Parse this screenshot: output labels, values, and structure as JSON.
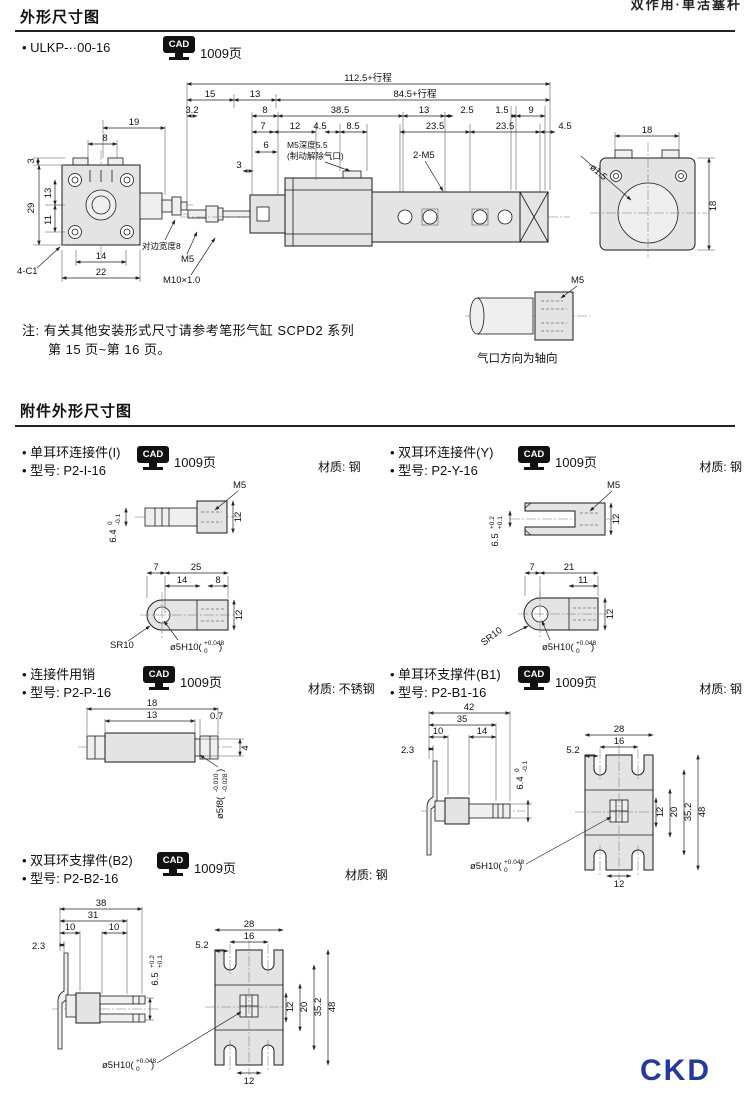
{
  "page": {
    "header_right": "双作用·单活塞杆",
    "logo": "CKD",
    "logo_color": "#2438a0"
  },
  "shared": {
    "cad_label": "CAD",
    "cad_page": "1009页",
    "hole_prefix": "ø5H10(",
    "hole_sup": "+0.048",
    "hole_sub": "0",
    "hole_close": ")"
  },
  "section1": {
    "title": "外形尺寸图",
    "model": "• ULKP-··00-16",
    "note1": "注: 有关其他安装形式尺寸请参考笔形气缸 SCPD2 系列",
    "note2": "第 15 页~第 16 页。",
    "port_caption": "气口方向为轴向",
    "main": {
      "total": "112.5+行程",
      "sub_total": "84.5+行程",
      "d15": "15",
      "d13a": "13",
      "d32": "3.2",
      "d8a": "8",
      "d385": "38.5",
      "d13b": "13",
      "d25a": "2.5",
      "d15b": "1.5",
      "d9": "9",
      "d7": "7",
      "d12": "12",
      "d45a": "4.5",
      "d85": "8.5",
      "d235a": "23.5",
      "d235b": "23.5",
      "d45b": "4.5",
      "d6": "6",
      "d3a": "3",
      "m5_depth": "M5深度5.5",
      "brake_port": "(制动解除气口)",
      "m5x2": "2-M5",
      "lv_19": "19",
      "lv_8": "8",
      "lv_3": "3",
      "lv_29": "29",
      "lv_13": "13",
      "lv_11": "11",
      "lv_14": "14",
      "lv_22": "22",
      "lv_c1": "4-C1",
      "lv_flats": "对边宽度8",
      "lv_m5": "M5",
      "lv_m10": "M10×1.0",
      "rv_18t": "18",
      "rv_18r": "18",
      "rv_hole": "·ø1.5",
      "port_m5": "M5"
    }
  },
  "section2": {
    "title": "附件外形尺寸图"
  },
  "blocks": {
    "i": {
      "name": "• 单耳环连接件(I)",
      "model": "• 型号: P2-I-16",
      "material": "材质: 钢",
      "m5": "M5",
      "d12t": "12",
      "d64": "6.4",
      "d64sup": "0",
      "d64sub": "-0.1",
      "d7": "7",
      "d25": "25",
      "d14": "14",
      "d8": "8",
      "d12b": "12",
      "sr": "SR10"
    },
    "y": {
      "name": "• 双耳环连接件(Y)",
      "model": "• 型号: P2-Y-16",
      "material": "材质: 钢",
      "m5": "M5",
      "d12t": "12",
      "d65": "6.5",
      "d65sup": "+0.2",
      "d65sub": "+0.1",
      "d7": "7",
      "d21": "21",
      "d11": "11",
      "d12b": "12",
      "sr": "SR10"
    },
    "p": {
      "name": "• 连接件用销",
      "model": "• 型号: P2-P-16",
      "material": "材质: 不锈钢",
      "d18": "18",
      "d13": "13",
      "d07": "0.7",
      "d4": "4",
      "shaft_prefix": "ø5f8(",
      "shaft_sup": "-0.010",
      "shaft_sub": "-0.028",
      "shaft_close": ")"
    },
    "b1": {
      "name": "• 单耳环支撑件(B1)",
      "model": "• 型号: P2-B1-16",
      "material": "材质: 钢",
      "d42": "42",
      "d35": "35",
      "d10": "10",
      "d14": "14",
      "d23": "2.3",
      "d64": "6.4",
      "d64sup": "0",
      "d64sub": "-0.1",
      "d28": "28",
      "d16": "16",
      "d52": "5.2",
      "d12": "12",
      "d20": "20",
      "d352": "35.2",
      "d48": "48",
      "d12b": "12"
    },
    "b2": {
      "name": "• 双耳环支撑件(B2)",
      "model": "• 型号: P2-B2-16",
      "material": "材质: 钢",
      "d38": "38",
      "d31": "31",
      "d10a": "10",
      "d10b": "10",
      "d23": "2.3",
      "d65": "6.5",
      "d65sup": "+0.2",
      "d65sub": "+0.1",
      "d28": "28",
      "d16": "16",
      "d52": "5.2",
      "d12": "12",
      "d20": "20",
      "d352": "35.2",
      "d48": "48",
      "d12b": "12"
    }
  }
}
